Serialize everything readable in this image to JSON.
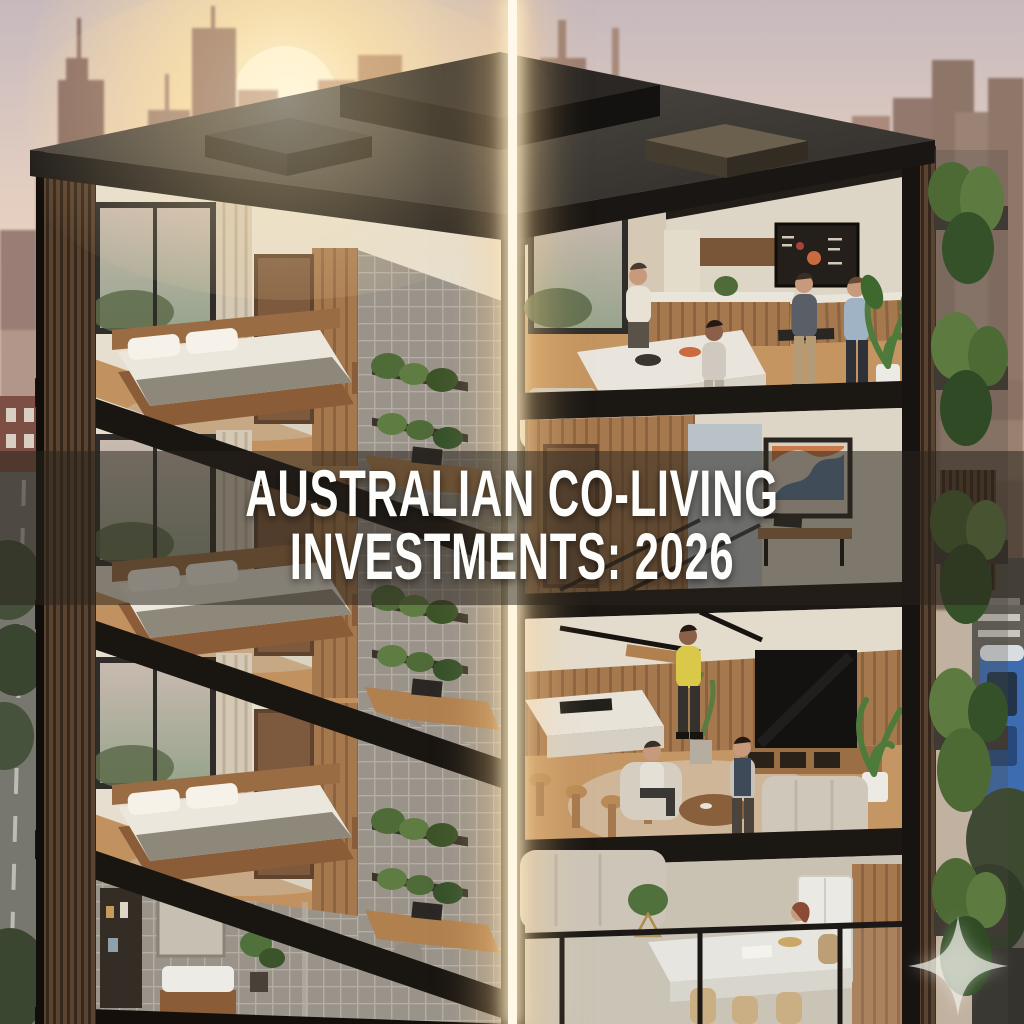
{
  "poster": {
    "title_line1": "AUSTRALIAN CO-LIVING",
    "title_line2": "INVESTMENTS: 2026"
  },
  "icons": {
    "watermark": "sparkle-icon"
  },
  "colors": {
    "title_text": "#fdfdfb",
    "title_band_overlay": "rgba(42,35,29,0.53)",
    "glow_divider": "#fff6e2",
    "sky_top": "#c6b9bd",
    "sunset_glow": "#ffedbe",
    "skyline_haze": "#a98b80",
    "roof_slate": "#3a3734",
    "structure_black": "#17130f",
    "timber_warm": "#a5784e",
    "wall_cream": "#e6dfd0",
    "tile_grey": "#99938a",
    "plant_green": "#51703a",
    "tram_blue": "#3d6db0"
  }
}
